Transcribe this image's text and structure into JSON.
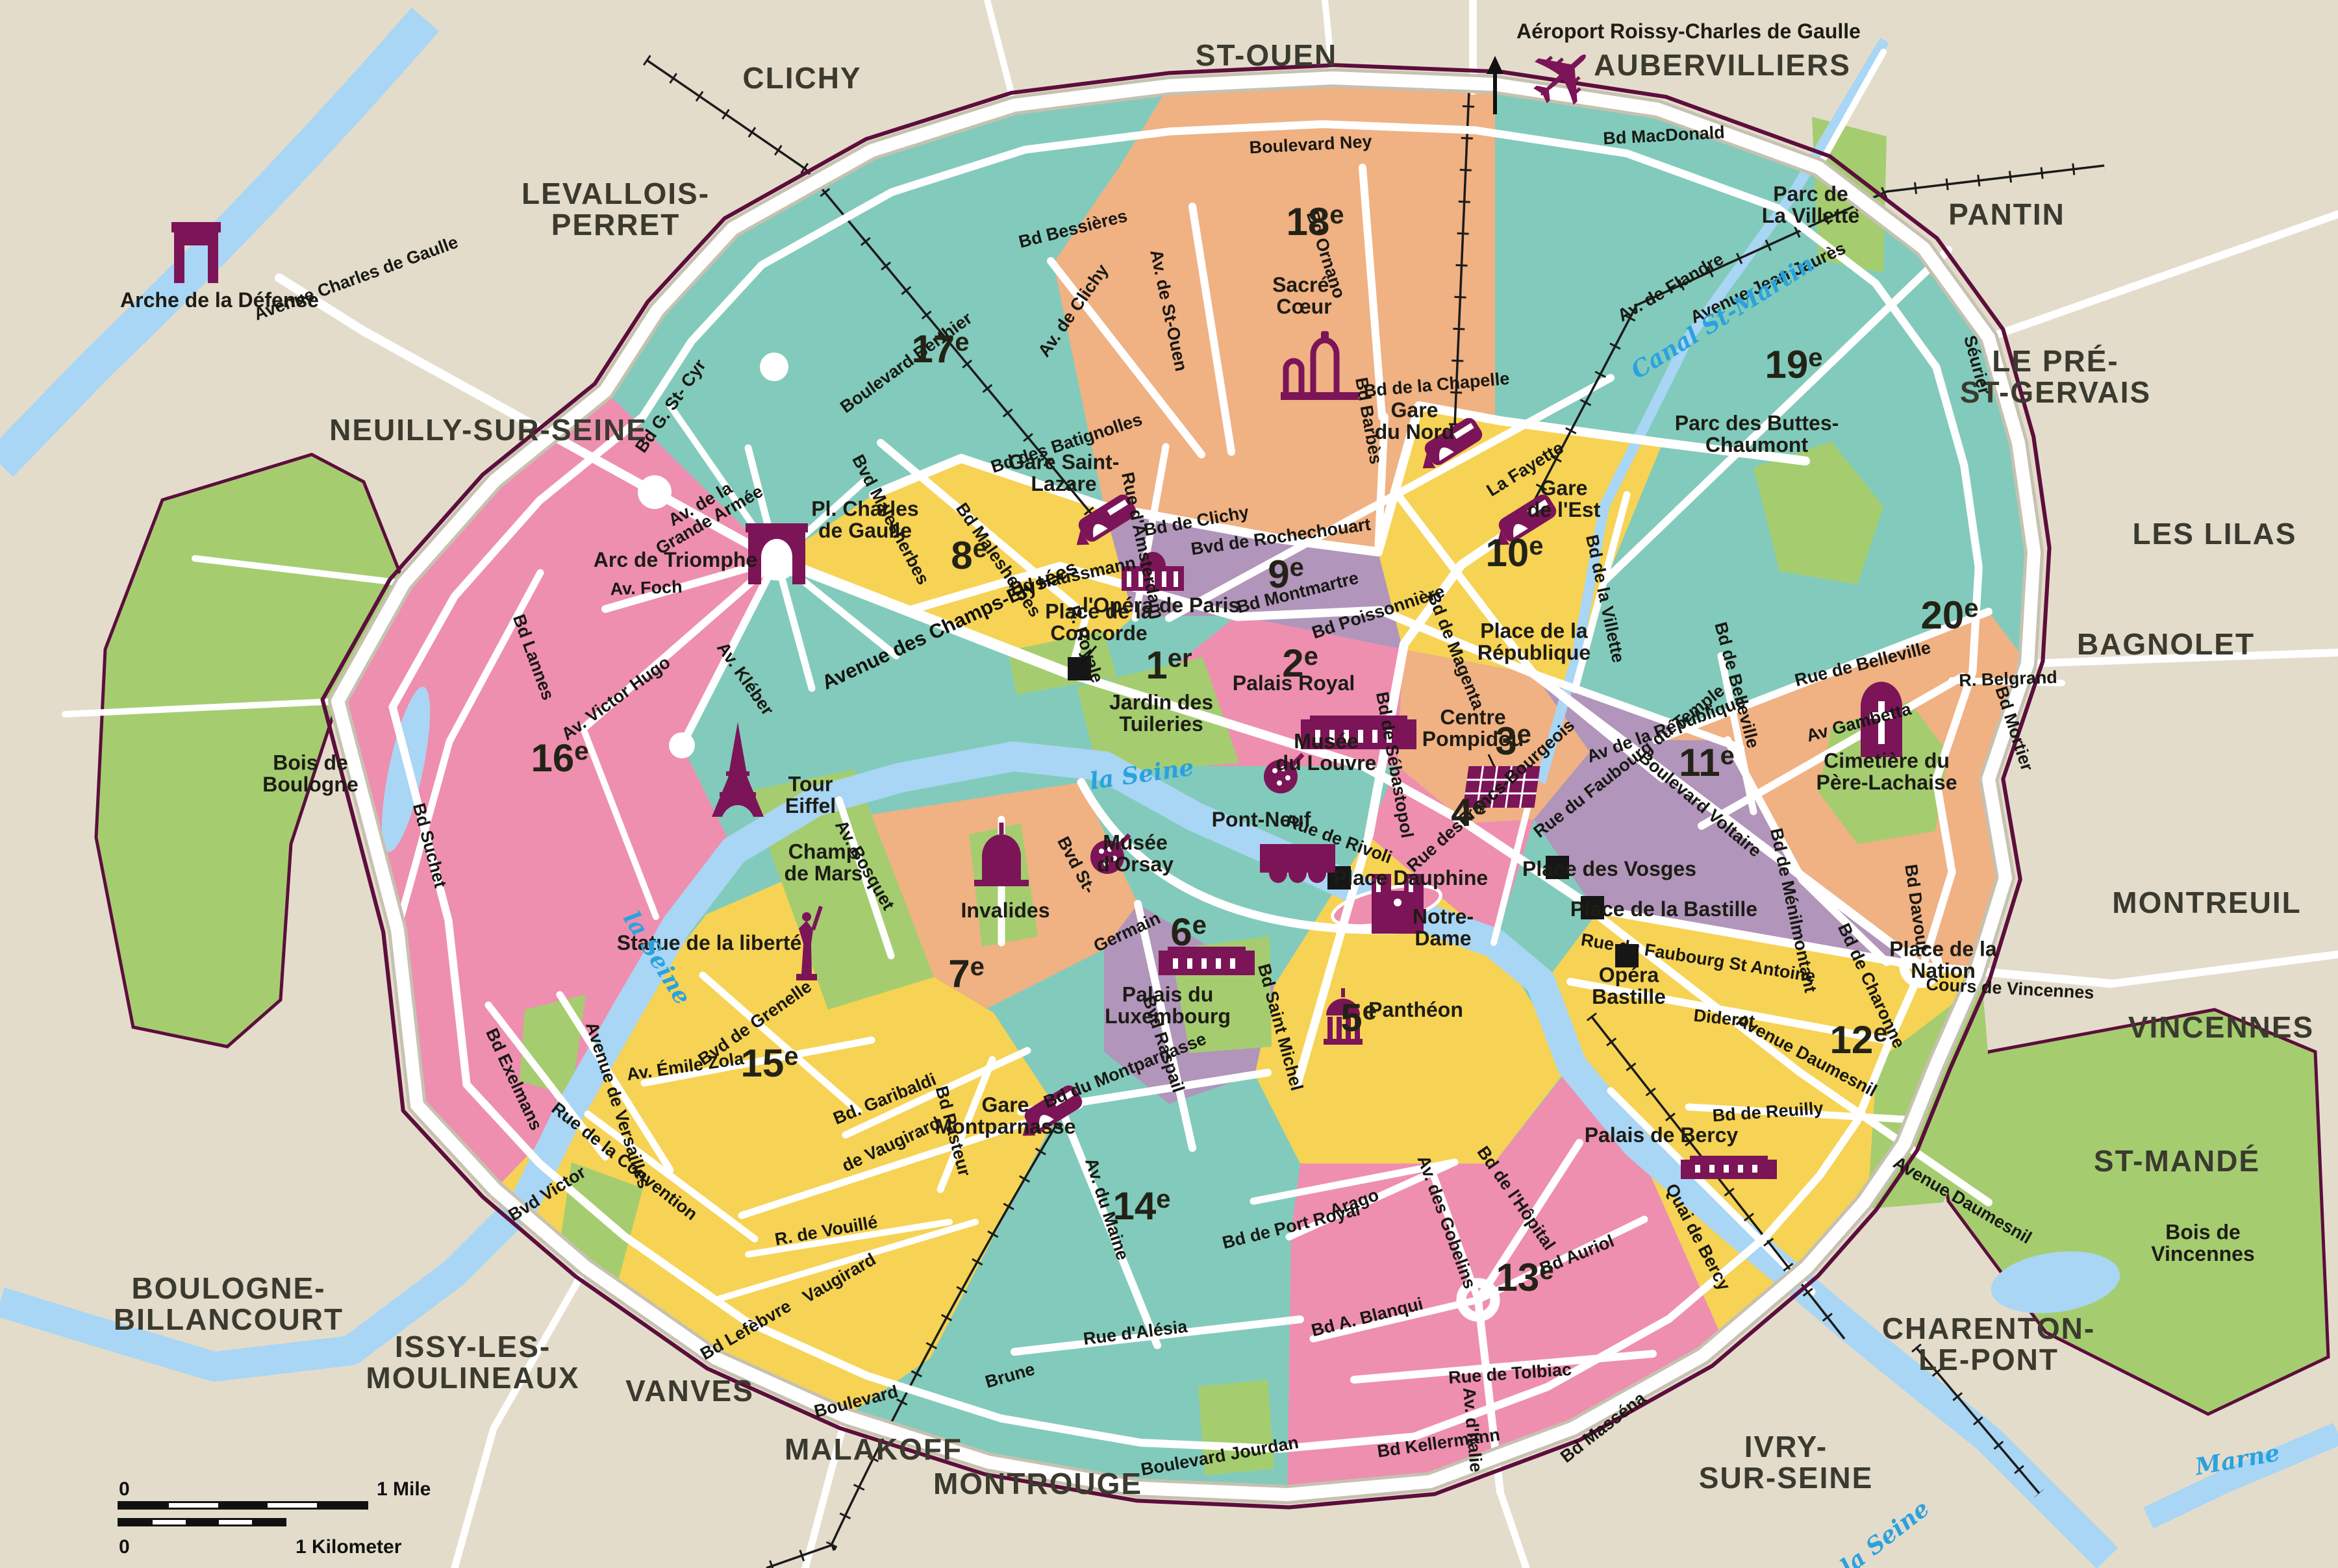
{
  "map_title": "Paris arrondissements tourist map",
  "colors": {
    "background": "#e4dccb",
    "teal": "#82cbbc",
    "yellow": "#f6d354",
    "pink": "#ee8fb0",
    "peach": "#f0b183",
    "purple": "#b195bb",
    "park_green": "#a5cd70",
    "water_blue": "#a9d6f4",
    "road_white": "#ffffff",
    "road_casing": "#c6c1b0",
    "city_boundary_maroon": "#5c0e3c",
    "landmark_maroon": "#7c1458",
    "rail_black": "#1b1b1b",
    "water_text_blue": "#2aa2df"
  },
  "scale_bar": {
    "zero_mile": "0",
    "mile": "1 Mile",
    "zero_km": "0",
    "kilometer": "1 Kilometer"
  },
  "airport": {
    "label": "Aéroport Roissy-Charles de Gaulle",
    "icon": "airplane-icon",
    "arrow": "north-arrow"
  },
  "arrondissements": [
    {
      "label": "1er"
    },
    {
      "label": "2e"
    },
    {
      "label": "3e"
    },
    {
      "label": "4e"
    },
    {
      "label": "5e"
    },
    {
      "label": "6e"
    },
    {
      "label": "7e"
    },
    {
      "label": "8e"
    },
    {
      "label": "9e"
    },
    {
      "label": "10e"
    },
    {
      "label": "11e"
    },
    {
      "label": "12e"
    },
    {
      "label": "13e"
    },
    {
      "label": "14e"
    },
    {
      "label": "15e"
    },
    {
      "label": "16e"
    },
    {
      "label": "17e"
    },
    {
      "label": "18e"
    },
    {
      "label": "19e"
    },
    {
      "label": "20e"
    }
  ],
  "suburbs": [
    {
      "label": "CLICHY"
    },
    {
      "label": "ST-OUEN"
    },
    {
      "label": "AUBERVILLIERS"
    },
    {
      "label": "PANTIN"
    },
    {
      "label": "LE PRÉ-\nST-GERVAIS"
    },
    {
      "label": "LES LILAS"
    },
    {
      "label": "BAGNOLET"
    },
    {
      "label": "MONTREUIL"
    },
    {
      "label": "VINCENNES"
    },
    {
      "label": "ST-MANDÉ"
    },
    {
      "label": "CHARENTON-\nLE-PONT"
    },
    {
      "label": "IVRY-\nSUR-SEINE"
    },
    {
      "label": "MONTROUGE"
    },
    {
      "label": "MALAKOFF"
    },
    {
      "label": "VANVES"
    },
    {
      "label": "ISSY-LES-\nMOULINEAUX"
    },
    {
      "label": "BOULOGNE-\nBILLANCOURT"
    },
    {
      "label": "LEVALLOIS-\nPERRET"
    },
    {
      "label": "NEUILLY-SUR-SEINE"
    }
  ],
  "landmarks": [
    {
      "label": "Arche de la Défense",
      "icon": "arch-icon"
    },
    {
      "label": "Arc de Triomphe",
      "icon": "arc-de-triomphe-icon"
    },
    {
      "label": "Pl. Charles\nde Gaulle"
    },
    {
      "label": "Gare Saint-\nLazare",
      "icon": "train-icon"
    },
    {
      "label": "Sacré-\nCœur",
      "icon": "basilica-icon"
    },
    {
      "label": "Gare\ndu Nord",
      "icon": "train-icon"
    },
    {
      "label": "Gare\nde l'Est",
      "icon": "train-icon"
    },
    {
      "label": "Parc de\nLa Villette"
    },
    {
      "label": "Parc des Buttes-\nChaumont"
    },
    {
      "label": "l'Opéra de Paris",
      "icon": "opera-icon"
    },
    {
      "label": "Place de la\nConcorde",
      "icon": "square-marker"
    },
    {
      "label": "Jardin des\nTuileries"
    },
    {
      "label": "Palais Royal",
      "icon": "palace-icon"
    },
    {
      "label": "Musée\ndu Louvre",
      "icon": "palette-icon"
    },
    {
      "label": "Centre\nPompidou",
      "icon": "pompidou-icon"
    },
    {
      "label": "Place de la\nRépublique"
    },
    {
      "label": "Pont-Neuf",
      "icon": "bridge-icon"
    },
    {
      "label": "Place Dauphine",
      "icon": "square-marker"
    },
    {
      "label": "Musée\nd'Orsay",
      "icon": "palette-icon"
    },
    {
      "label": "Notre-\nDame",
      "icon": "cathedral-icon"
    },
    {
      "label": "Panthéon",
      "icon": "pantheon-icon"
    },
    {
      "label": "Palais du\nLuxembourg",
      "icon": "palace-icon"
    },
    {
      "label": "Invalides",
      "icon": "dome-icon"
    },
    {
      "label": "Tour\nEiffel",
      "icon": "eiffel-tower-icon"
    },
    {
      "label": "Champ\nde Mars"
    },
    {
      "label": "Statue de la liberté",
      "icon": "statue-of-liberty-icon"
    },
    {
      "label": "Gare\nMontparnasse",
      "icon": "train-icon"
    },
    {
      "label": "Cimetière du\nPère-Lachaise",
      "icon": "cross-icon"
    },
    {
      "label": "Place des Vosges",
      "icon": "square-marker"
    },
    {
      "label": "Place de la Bastille",
      "icon": "square-marker"
    },
    {
      "label": "Opéra\nBastille",
      "icon": "square-marker"
    },
    {
      "label": "Place de la\nNation"
    },
    {
      "label": "Palais de Bercy",
      "icon": "palace-icon"
    },
    {
      "label": "Bois de\nBoulogne"
    },
    {
      "label": "Bois de\nVincennes"
    }
  ],
  "streets": [
    {
      "label": "Bd MacDonald"
    },
    {
      "label": "Boulevard Ney"
    },
    {
      "label": "Bd Ornano"
    },
    {
      "label": "Bd Barbès"
    },
    {
      "label": "Bd de la Chapelle"
    },
    {
      "label": "Av. de St-Ouen"
    },
    {
      "label": "Av. de Clichy"
    },
    {
      "label": "Bd Bessières"
    },
    {
      "label": "Boulevard Berthier"
    },
    {
      "label": "Bvd Malesherbes"
    },
    {
      "label": "Bd des Batignolles"
    },
    {
      "label": "Bd de Clichy"
    },
    {
      "label": "Bvd de Rochechouart"
    },
    {
      "label": "Rue d'Amsterdam"
    },
    {
      "label": "Bd Malesherbes"
    },
    {
      "label": "Bd Haussmann"
    },
    {
      "label": "Bd Montmartre"
    },
    {
      "label": "Bd Poissonnière"
    },
    {
      "label": "Bd de Magenta"
    },
    {
      "label": "La Fayette"
    },
    {
      "label": "Bd de la Villette"
    },
    {
      "label": "Avenue Jean Jaurès"
    },
    {
      "label": "Séurier"
    },
    {
      "label": "Av. de Flandre"
    },
    {
      "label": "Rue de Belleville"
    },
    {
      "label": "Bd Mortier"
    },
    {
      "label": "Av de la République"
    },
    {
      "label": "Boulevard Voltaire"
    },
    {
      "label": "Rue du Faubourg du Temple"
    },
    {
      "label": "Av Gambetta"
    },
    {
      "label": "R. Belgrand"
    },
    {
      "label": "Bd Davout"
    },
    {
      "label": "Bd de Ménilmontant"
    },
    {
      "label": "Bd de Charonne"
    },
    {
      "label": "Rue du Faubourg St Antoine"
    },
    {
      "label": "Cours de Vincennes"
    },
    {
      "label": "Diderot"
    },
    {
      "label": "Avenue Daumesnil"
    },
    {
      "label": "Avenue Daumesnil"
    },
    {
      "label": "Bd de Reuilly"
    },
    {
      "label": "Quai de Bercy"
    },
    {
      "label": "Bd Masséna"
    },
    {
      "label": "Bd Kellermann"
    },
    {
      "label": "Rue de Tolbiac"
    },
    {
      "label": "Av. d'Italie"
    },
    {
      "label": "Av. des Gobelins"
    },
    {
      "label": "Bd de l'Hôpital"
    },
    {
      "label": "Bd Auriol"
    },
    {
      "label": "Bd A. Blanqui"
    },
    {
      "label": "Arago"
    },
    {
      "label": "Bd de Port Royal"
    },
    {
      "label": "Bd Saint Michel"
    },
    {
      "label": "Bvd St-"
    },
    {
      "label": "Germain"
    },
    {
      "label": "Bvd Raspail"
    },
    {
      "label": "Bd du Montparnasse"
    },
    {
      "label": "Av. du Maine"
    },
    {
      "label": "Rue d'Alésia"
    },
    {
      "label": "Brune"
    },
    {
      "label": "Boulevard"
    },
    {
      "label": "Boulevard Jourdan"
    },
    {
      "label": "Bd Lefèbvre"
    },
    {
      "label": "Bvd Victor"
    },
    {
      "label": "R. de Vouillé"
    },
    {
      "label": "de Vaugirard"
    },
    {
      "label": "Vaugirard"
    },
    {
      "label": "Bd Pasteur"
    },
    {
      "label": "Bd. Garibaldi"
    },
    {
      "label": "Bvd de Grenelle"
    },
    {
      "label": "Av. Émile Zola"
    },
    {
      "label": "Rue de la Convention"
    },
    {
      "label": "Av. Bosquet"
    },
    {
      "label": "Av. Foch"
    },
    {
      "label": "Av. Kléber"
    },
    {
      "label": "Av. Victor Hugo"
    },
    {
      "label": "Bd Lannes"
    },
    {
      "label": "Bd Suchet"
    },
    {
      "label": "Bd Exelmans"
    },
    {
      "label": "Avenue de Versailles"
    },
    {
      "label": "Av. de la\nGrande Armée"
    },
    {
      "label": "Bd G. St- Cyr"
    },
    {
      "label": "Avenue Charles de Gaulle"
    },
    {
      "label": "Avenue des Champs-Élysées"
    },
    {
      "label": "Rue de Rivoli"
    },
    {
      "label": "Bd de Sébastopol"
    },
    {
      "label": "Rue desFrancs-Bourgeois"
    },
    {
      "label": "R. Royale"
    },
    {
      "label": "Bd de Belleville"
    }
  ],
  "water_labels": [
    {
      "label": "la Seine"
    },
    {
      "label": "la Seine"
    },
    {
      "label": "la Seine"
    },
    {
      "label": "Marne"
    },
    {
      "label": "Canal St-Martin"
    }
  ]
}
